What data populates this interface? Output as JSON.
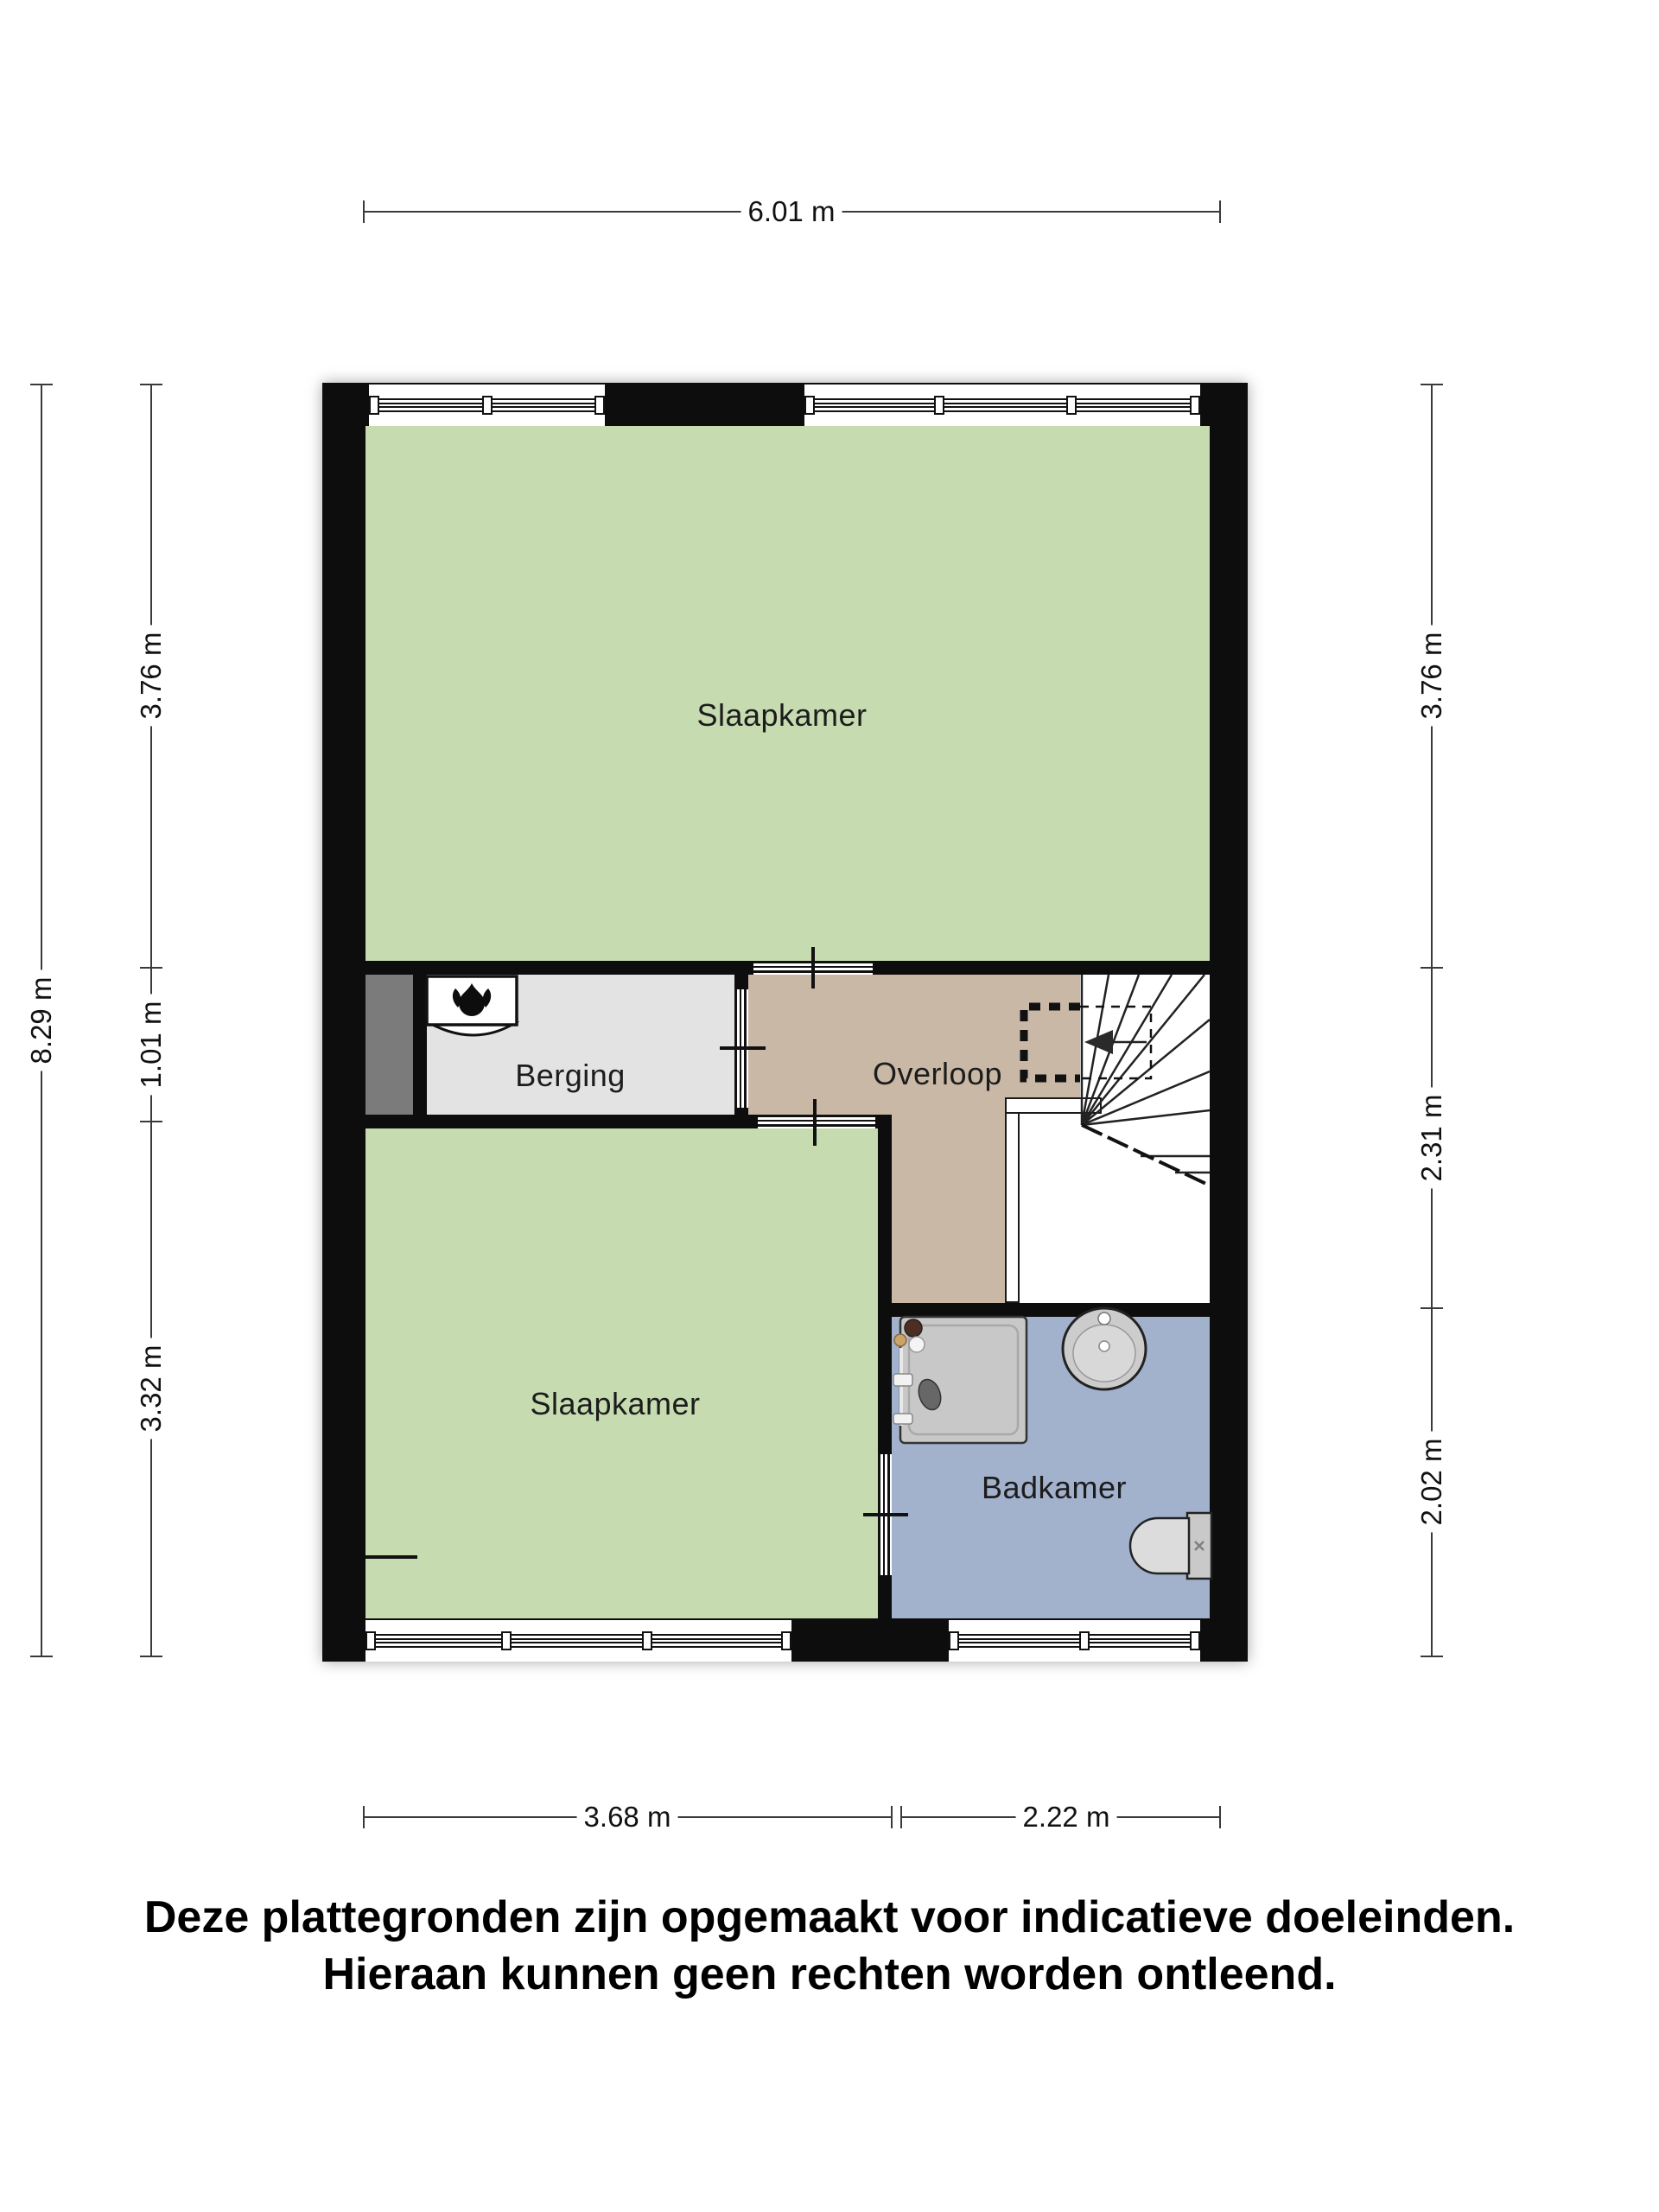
{
  "floor_plan": {
    "rooms": {
      "slaapkamer_top": {
        "label": "Slaapkamer",
        "color": "#c6dbb0"
      },
      "berging": {
        "label": "Berging",
        "color": "#e3e3e3"
      },
      "overloop": {
        "label": "Overloop",
        "color": "#c9b8a5"
      },
      "slaapkamer_bottom": {
        "label": "Slaapkamer",
        "color": "#c6dbb0"
      },
      "badkamer": {
        "label": "Badkamer",
        "color": "#a2b2cd"
      }
    },
    "dimensions": {
      "width_top": "6.01 m",
      "height_left": "8.29 m",
      "left": [
        "3.76 m",
        "1.01 m",
        "3.32 m"
      ],
      "right": [
        "3.76 m",
        "2.31 m",
        "2.02 m"
      ],
      "bottom": [
        "3.68 m",
        "2.22 m"
      ]
    },
    "colors": {
      "wall": "#0d0d0d",
      "bedroom_green": "#c6dbb0",
      "landing_tan": "#c9b8a5",
      "storage_gray": "#e3e3e3",
      "bathroom_blue": "#a2b2cd",
      "shaft_dark_gray": "#7b7b7b"
    },
    "icons": [
      "boiler-flame-icon",
      "stairs-direction-arrow-icon",
      "shower-icon",
      "sink-icon",
      "toilet-icon"
    ]
  },
  "disclaimer": {
    "line1": "Deze plattegronden zijn opgemaakt voor indicatieve doeleinden.",
    "line2": "Hieraan kunnen geen rechten worden ontleend."
  }
}
